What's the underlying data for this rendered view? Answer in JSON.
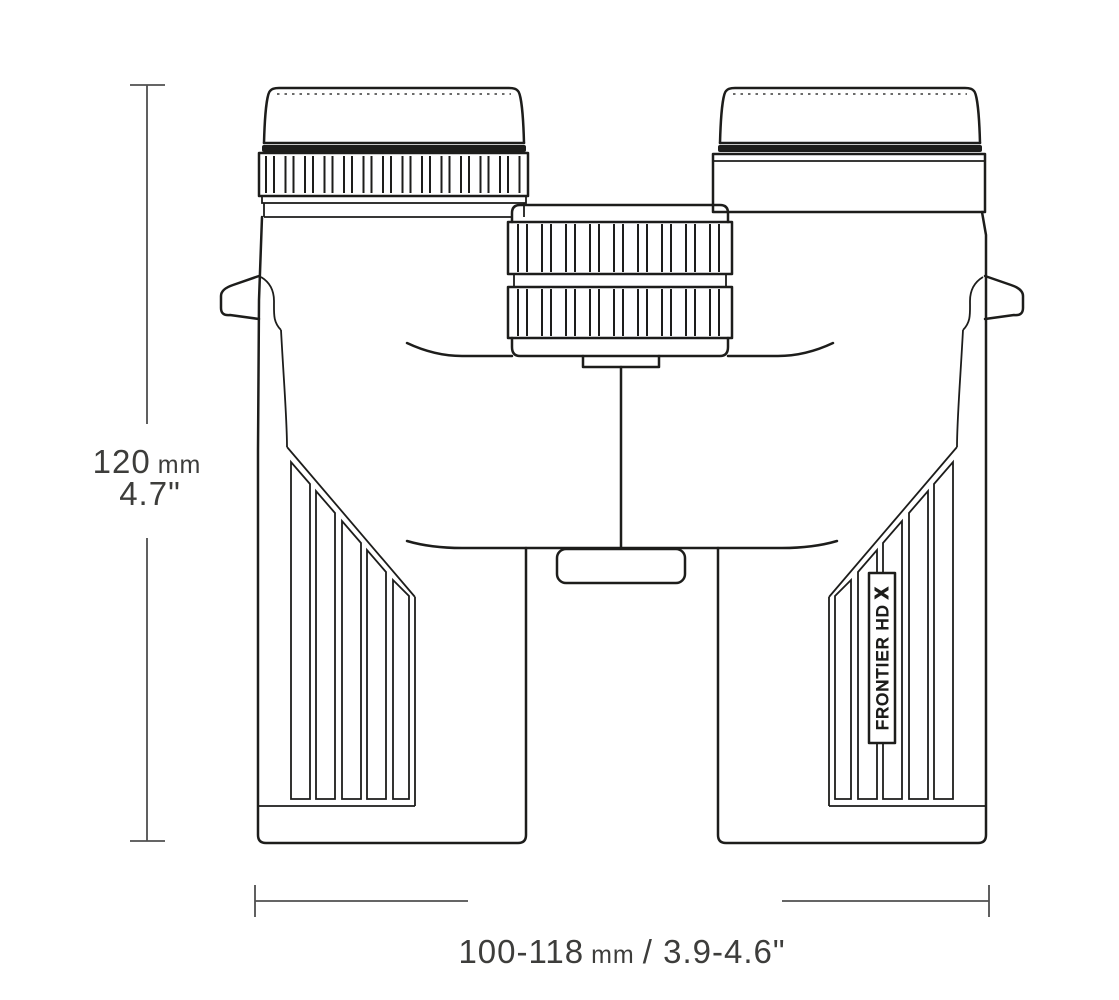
{
  "diagram": {
    "subject": "binoculars-front-dimension-drawing",
    "dimensions": {
      "height": {
        "value": "120",
        "unit": "mm",
        "inches": "4.7\""
      },
      "width": {
        "value": "100-118",
        "unit": "mm",
        "inches": "/ 3.9-4.6\""
      }
    },
    "product": {
      "badge_name": "FRONTIER HD",
      "badge_variant": "X"
    }
  },
  "colors": {
    "ink": "#1d1d1b",
    "dimension_line": "#4f4f4f",
    "dimension_text": "#3d3d3b",
    "background": "#ffffff"
  }
}
